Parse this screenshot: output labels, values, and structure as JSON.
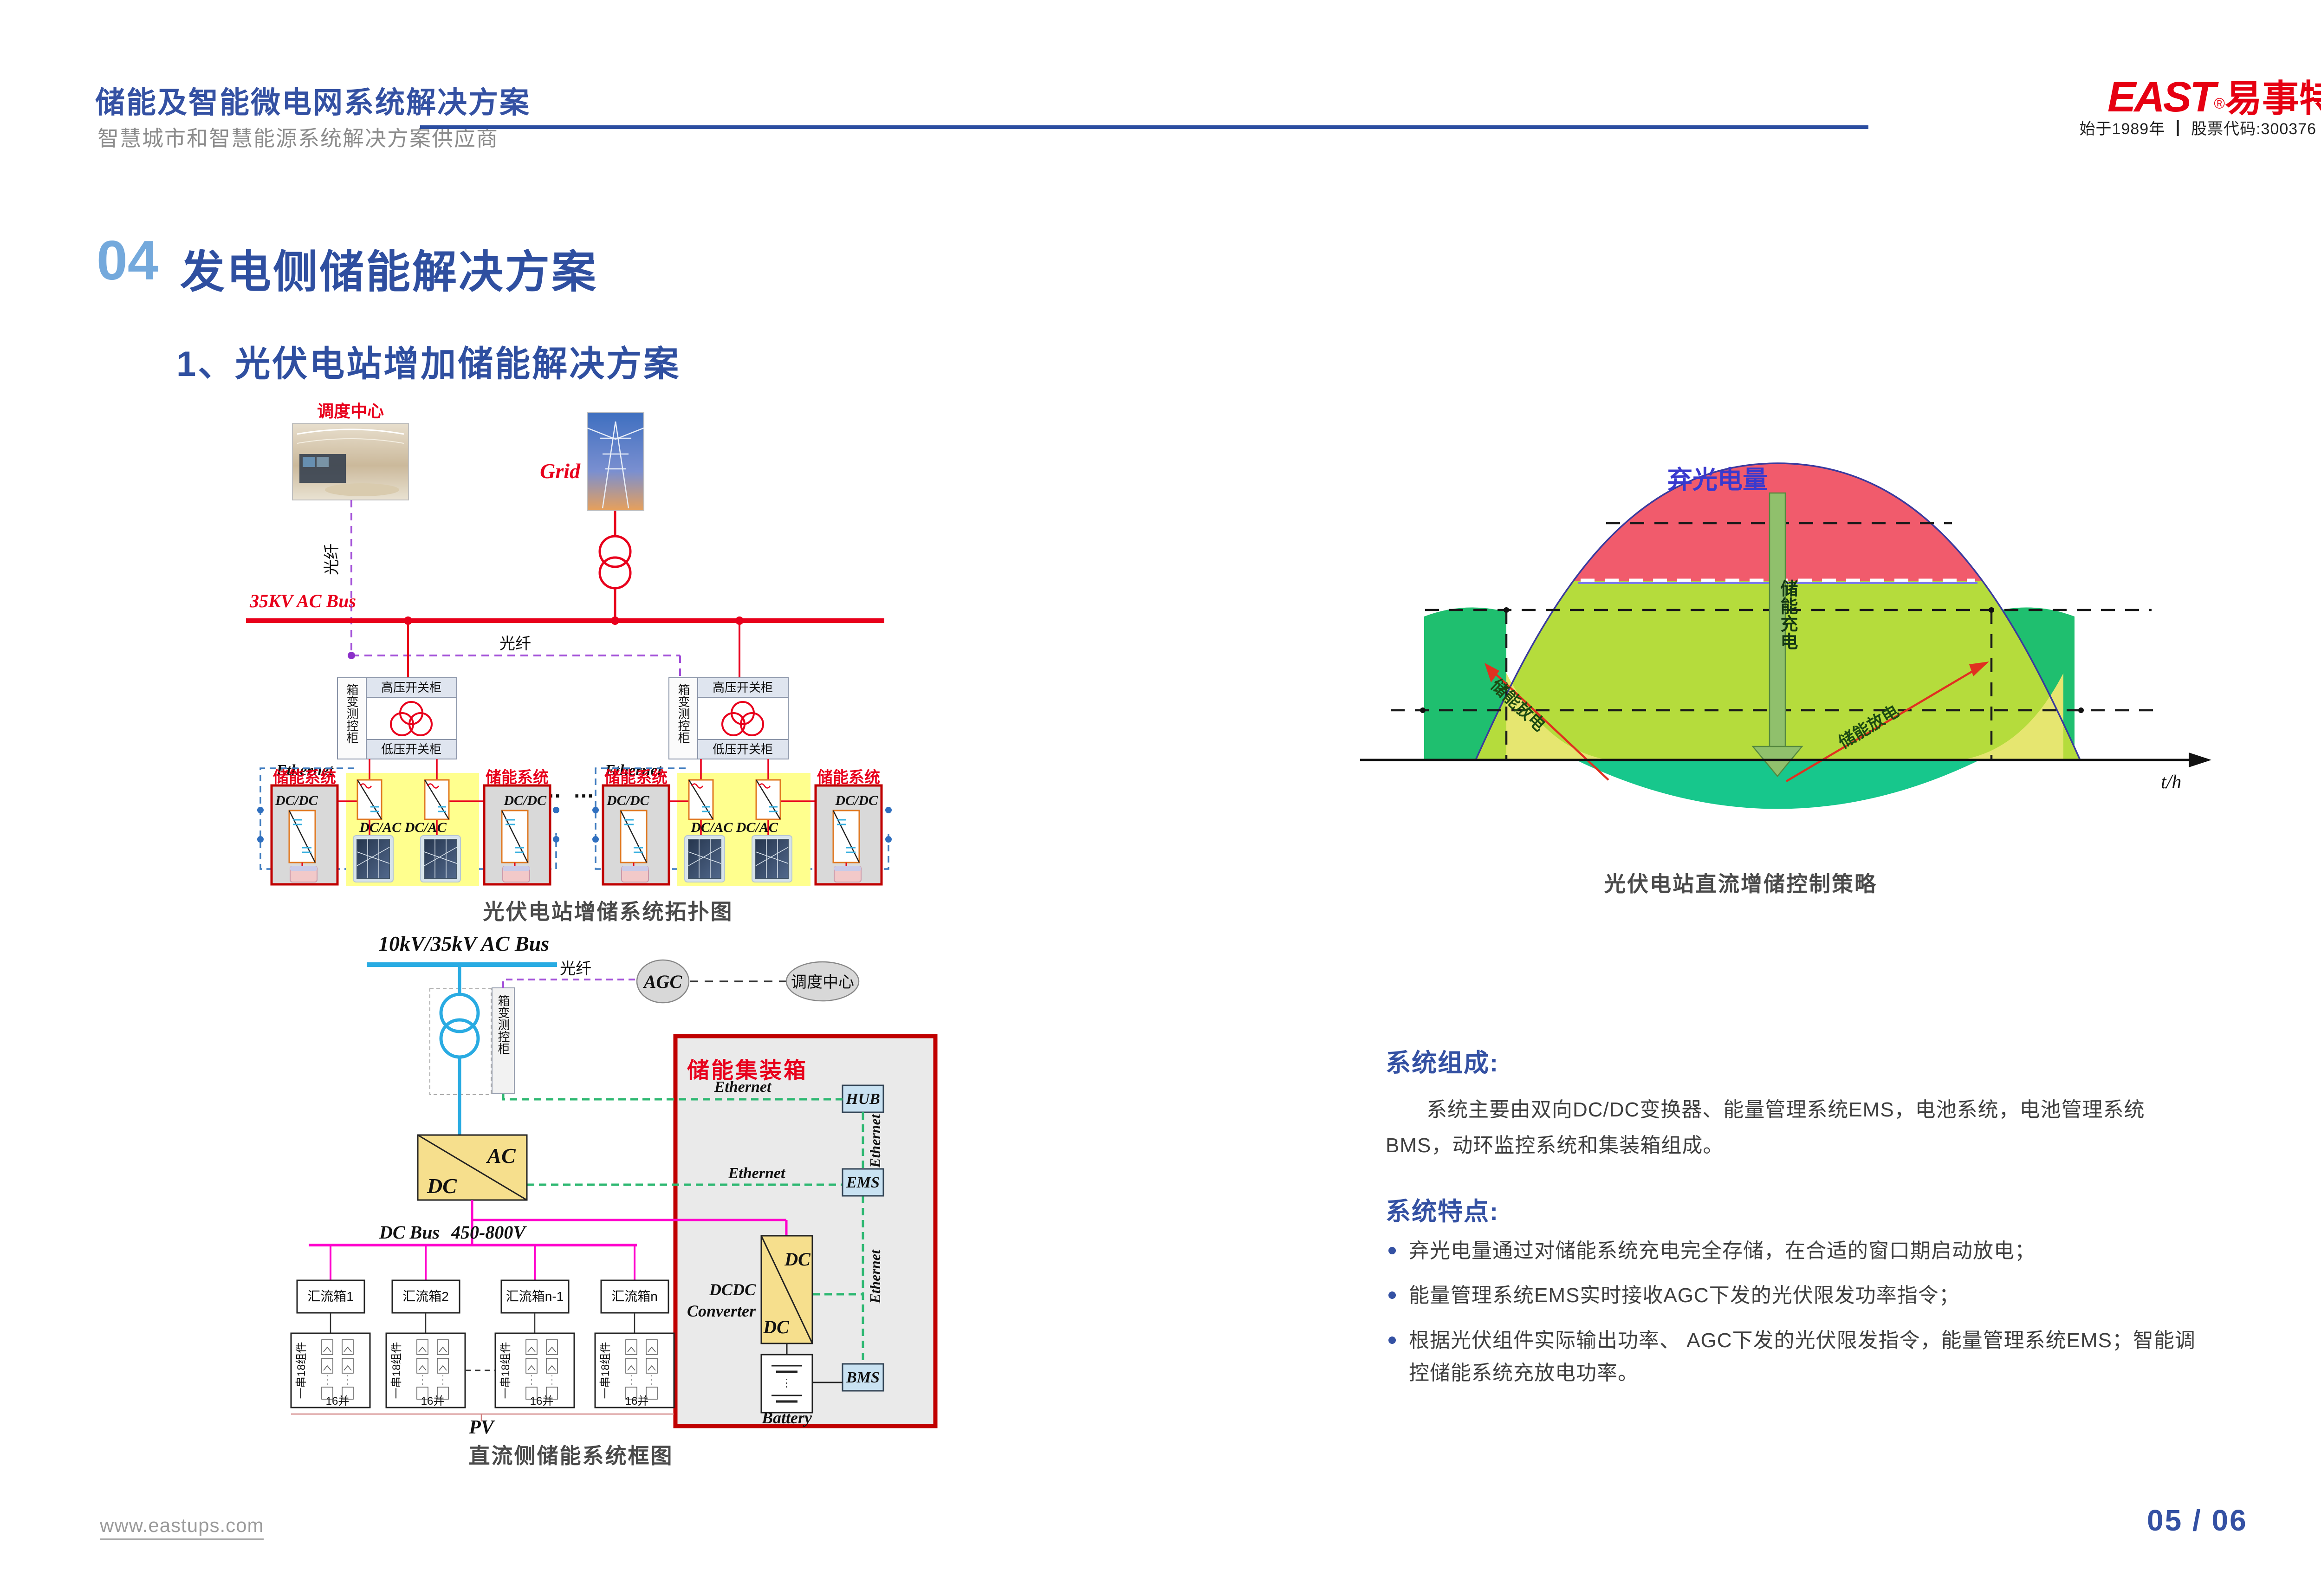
{
  "header": {
    "title": "储能及智能微电网系统解决方案",
    "subtitle": "智慧城市和智慧能源系统解决方案供应商",
    "logo_east": "EAST",
    "logo_reg": "®",
    "logo_cn": "易事特",
    "logo_tagline": "始于1989年 ┃ 股票代码:300376"
  },
  "section": {
    "number": "04",
    "title": "发电侧储能解决方案",
    "subtitle": "1、光伏电站增加储能解决方案"
  },
  "topology": {
    "caption": "光伏电站增储系统拓扑图",
    "dispatch_center": "调度中心",
    "grid": "Grid",
    "fiber_v": "光纤",
    "fiber_h": "光纤",
    "bus": "35KV AC Bus",
    "box_cabinet": "箱变测控柜",
    "hv_cabinet": "高压开关柜",
    "lv_cabinet": "低压开关柜",
    "ethernet": "Ethernet",
    "ess": "储能系统",
    "dcdc": "DC/DC",
    "dcac": "DC/AC DC/AC",
    "dots": "…  …"
  },
  "strategy": {
    "caption": "光伏电站直流增储控制策略",
    "curtailed": "弃光电量",
    "charge": "储能充电",
    "discharge": "储能放电",
    "axis": "t/h"
  },
  "chart_data": {
    "type": "area",
    "title": "光伏电站直流增储控制策略",
    "xlabel": "t/h",
    "series_description": "光伏日出力呈钟形曲线；限发线以上红色区域为弃光电量，经储能充电箭头存入储能；两侧绿色梯形为储能放电窗口，红色斜箭头表示储能放电方向",
    "regions": [
      {
        "label": "弃光电量",
        "color": "#F15B6C"
      },
      {
        "label": "光伏出力（可上网部分）",
        "color": "#B5DC3C"
      },
      {
        "label": "储能放电窗口",
        "color": "#1FBF6F"
      },
      {
        "label": "夜间低谷",
        "color": "#17C78C"
      }
    ],
    "annotations": [
      "弃光电量",
      "储能充电",
      "储能放电",
      "储能放电",
      "t/h"
    ],
    "legend_position": "none",
    "grid": false
  },
  "dc_diagram": {
    "caption": "直流侧储能系统框图",
    "bus": "10kV/35kV AC Bus",
    "fiber": "光纤",
    "agc": "AGC",
    "dispatch": "调度中心",
    "box_cabinet": "箱变测控柜",
    "container": "储能集装箱",
    "ethernet": "Ethernet",
    "hub": "HUB",
    "ems": "EMS",
    "ac": "AC",
    "dc": "DC",
    "dc_bus": "DC Bus",
    "dc_bus_range": "450-800V",
    "combiners": [
      "汇流箱1",
      "汇流箱2",
      "汇流箱n-1",
      "汇流箱n"
    ],
    "string_label": "一串18组件",
    "parallel_label": "16并",
    "pv": "PV",
    "dcdc_line1": "DCDC",
    "dcdc_line2": "Converter",
    "battery": "Battery",
    "bms": "BMS"
  },
  "content": {
    "composition_title": "系统组成:",
    "composition_body": "系统主要由双向DC/DC变换器、能量管理系统EMS，电池系统，电池管理系统BMS，动环监控系统和集装箱组成。",
    "features_title": "系统特点:",
    "features": [
      "弃光电量通过对储能系统充电完全存储，在合适的窗口期启动放电；",
      "能量管理系统EMS实时接收AGC下发的光伏限发功率指令；",
      "根据光伏组件实际输出功率、 AGC下发的光伏限发指令，能量管理系统EMS；智能调控储能系统充放电功率。"
    ]
  },
  "footer": {
    "website": "www.eastups.com",
    "page": "05 / 06"
  },
  "colors": {
    "accent_blue": "#3451A3",
    "light_blue": "#74A9DC",
    "brand_red": "#E60012",
    "diagram_red": "#E8001C",
    "fiber_purple": "#A24FD8",
    "ethernet_blue": "#3E7BBF",
    "ethernet_green": "#2EB872",
    "cyan_bus": "#29ABE2",
    "magenta_bus": "#FF00CC",
    "yellow_zone": "#FFFF8E",
    "chart_red": "#F15B6C",
    "chart_green": "#B5DC3C",
    "chart_dark_green": "#1FBF6F"
  }
}
